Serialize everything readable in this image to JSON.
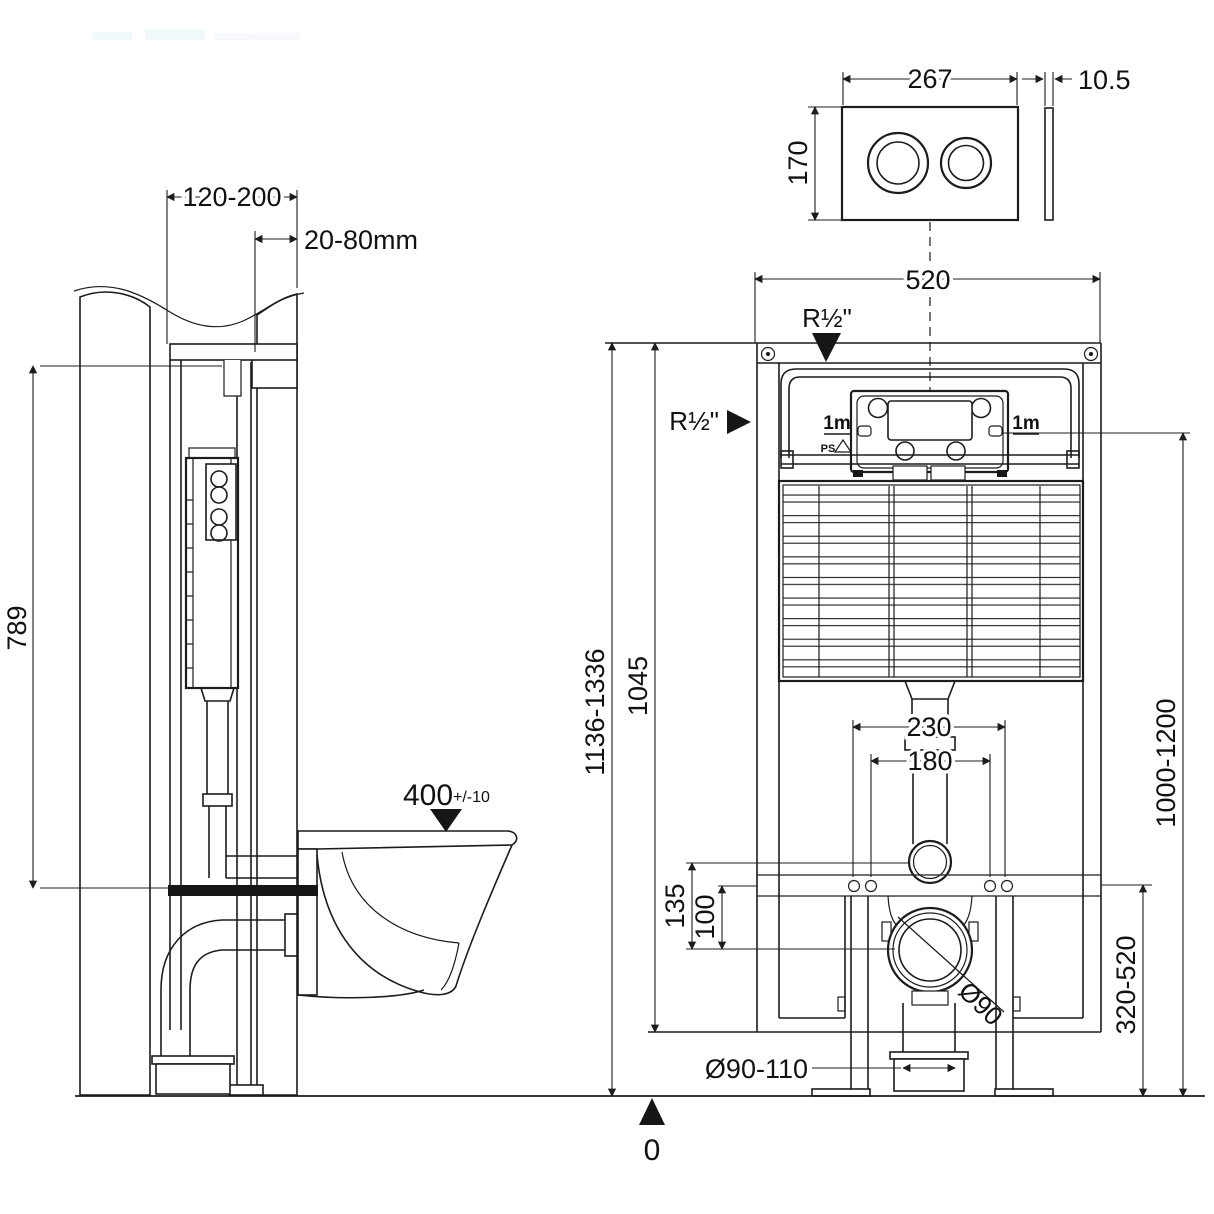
{
  "colors": {
    "line": "#1c1c1c",
    "background": "#ffffff"
  },
  "side_view": {
    "frame_depth": "120-200",
    "finished_wall_thickness": "20-80mm",
    "hanger_to_seat_height": "789",
    "bowl_rim_height": "400",
    "bowl_rim_tolerance": "+/-10"
  },
  "flush_plate": {
    "width": "267",
    "height": "170",
    "thickness": "10.5"
  },
  "front_view": {
    "frame_width": "520",
    "water_inlet_top": "R½\"",
    "water_inlet_side": "R½\"",
    "hose_left": "1m",
    "hose_right": "1m",
    "material_code": "PS",
    "outlet_centres": "230",
    "fixing_bolt_centres": "180",
    "flushpipe_to_waste": "135",
    "rail_to_waste": "100",
    "overall_height": "1136-1336",
    "frame_height": "1045",
    "inlet_height": "1000-1200",
    "waste_height_range": "320-520",
    "waste_diameter": "Ø90",
    "waste_socket_diameter": "Ø90-110",
    "floor_datum": "0"
  }
}
